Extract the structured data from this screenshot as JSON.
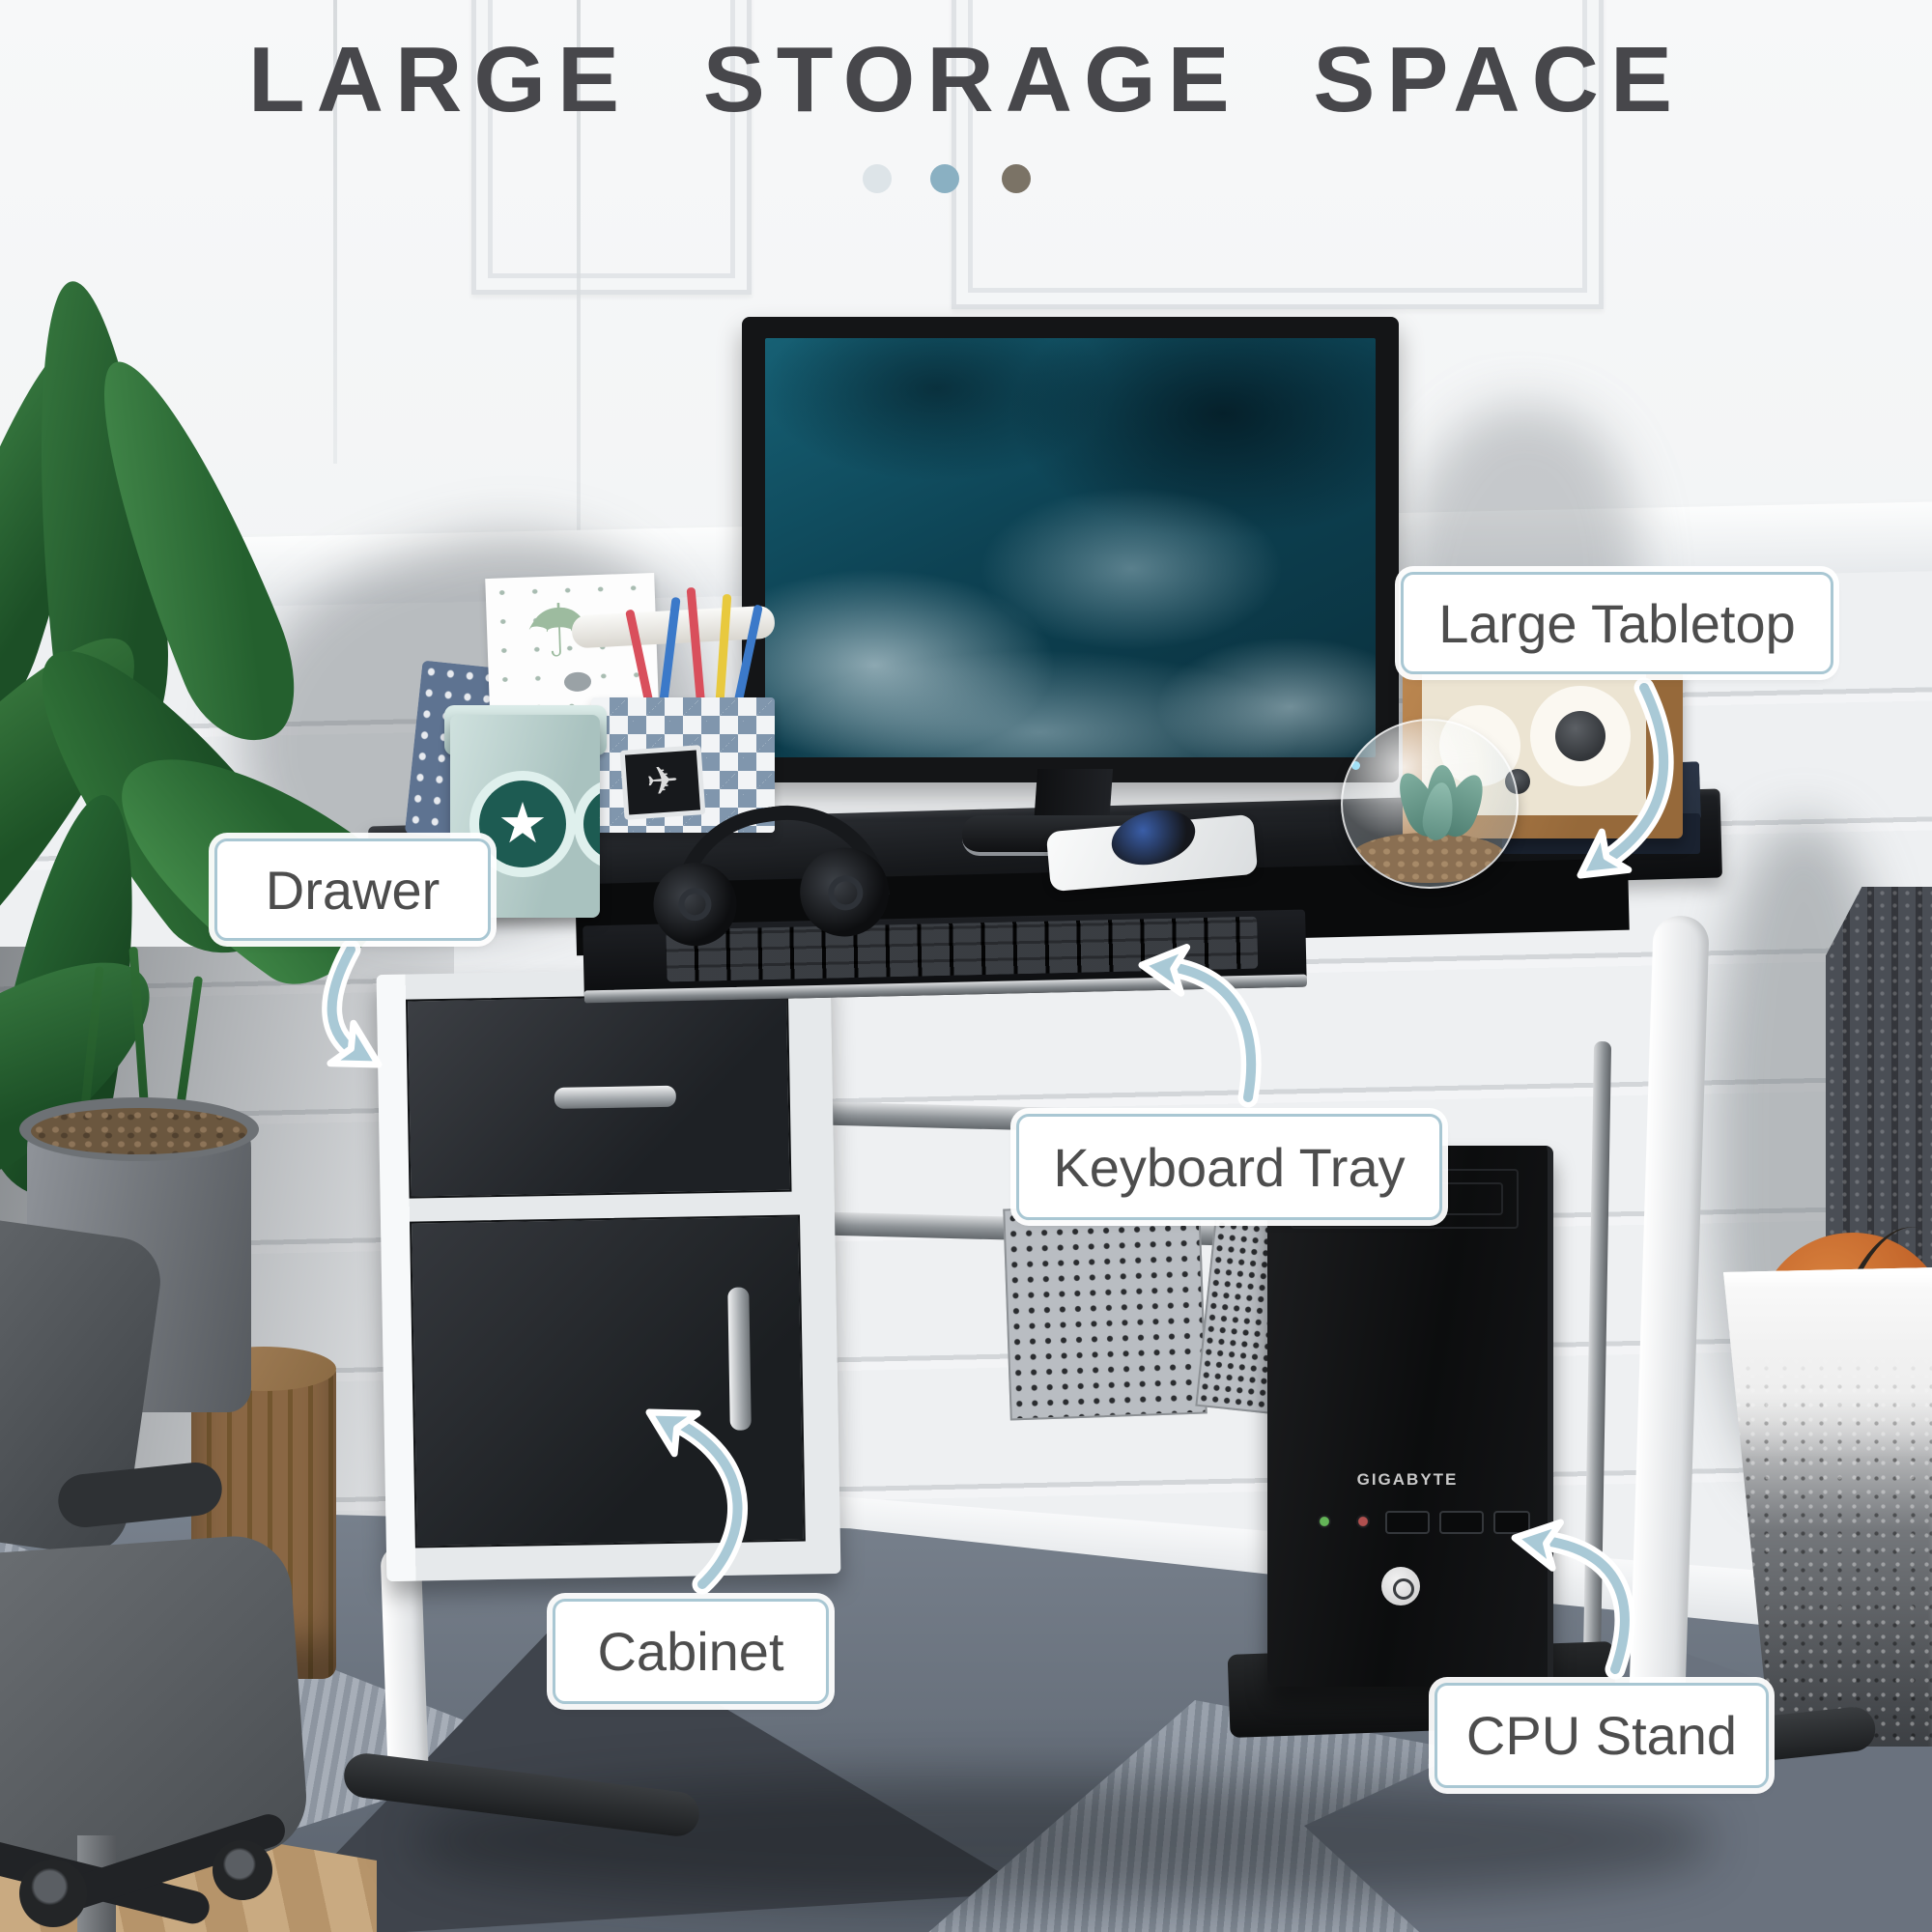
{
  "title": "LARGE STORAGE SPACE",
  "pagination_dots": [
    {
      "name": "dot-1",
      "color": "#dde4e8"
    },
    {
      "name": "dot-2",
      "color": "#8ab0c2"
    },
    {
      "name": "dot-3",
      "color": "#7b7366"
    }
  ],
  "callouts": [
    {
      "id": "large-tabletop",
      "label": "Large Tabletop"
    },
    {
      "id": "drawer",
      "label": "Drawer"
    },
    {
      "id": "keyboard-tray",
      "label": "Keyboard Tray"
    },
    {
      "id": "cabinet",
      "label": "Cabinet"
    },
    {
      "id": "cpu-stand",
      "label": "CPU Stand"
    }
  ],
  "colors": {
    "title_text": "#47474b",
    "callout_border": "#a9c7d3",
    "callout_text": "#4d4d4d",
    "arrow": "#a9c9d6"
  },
  "scene": {
    "cpu_brand": "GIGABYTE",
    "decor_glyphs": {
      "star": "★",
      "umbrella": "☂",
      "paper_plane": "✈"
    }
  }
}
